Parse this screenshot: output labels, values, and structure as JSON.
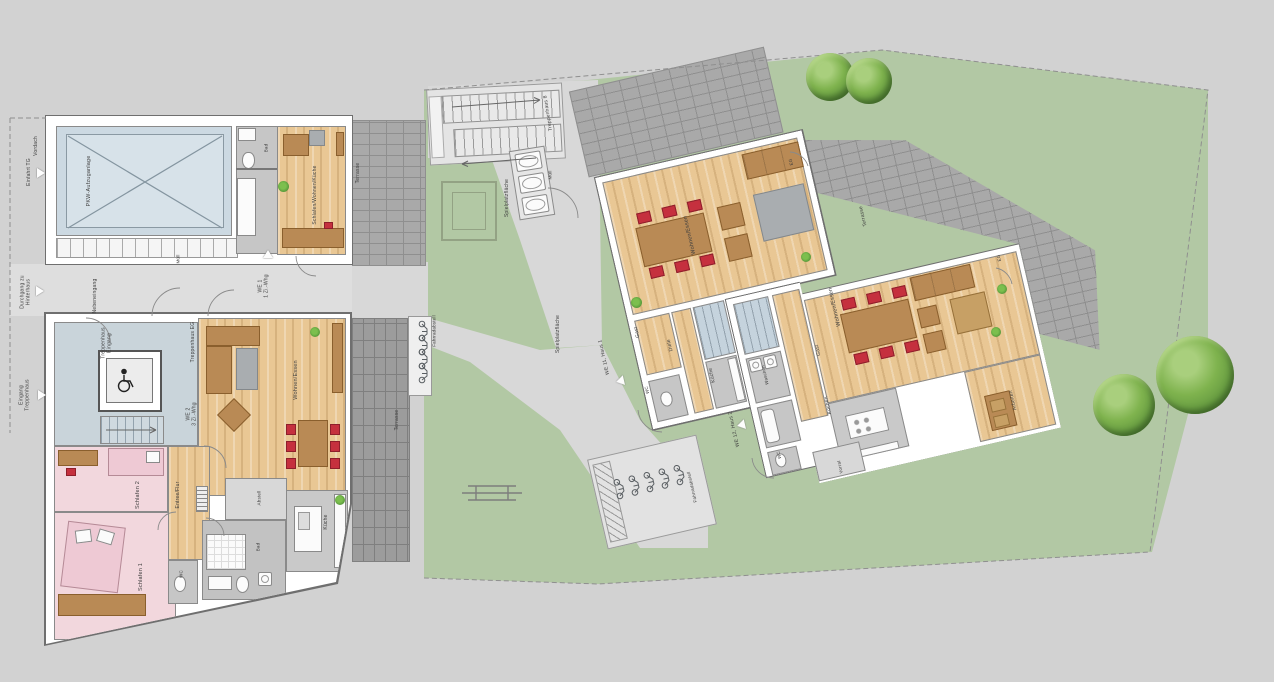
{
  "plan": {
    "title": "Lageplan Erdgeschoss Wohnanlage",
    "colors": {
      "lawn_green": "#b2c8a4",
      "path_grey": "#d8d8d8",
      "terrace_brick": "#a9a9a9",
      "terrace_brick_dark": "#9c9c9c",
      "wood_floor": "#e9c794",
      "stairwell_blue": "#c9d4da",
      "bedroom_pink": "#f2d7dd",
      "chair_red": "#c5303e",
      "furniture_brown": "#b98a55",
      "wall_white": "#ffffff",
      "label_grey": "#3f3f3f",
      "tree_green": "#6fae4b",
      "car_lift_blue": "#ccd9e2"
    },
    "icons": {
      "wheelchair-icon": "accessible elevator symbol",
      "bike-icon": "bicycle parking symbol",
      "picnic-table-icon": "bench/table symbol",
      "tree-icon": "garden tree",
      "plant-icon": "indoor plant",
      "stair-arrow-icon": "stair direction arrow",
      "direction-arrow-icon": "entrance direction triangle",
      "cross-icon": "car lift platform X marking"
    },
    "labels": [
      {
        "n": "vordach",
        "t": "Vordach",
        "x": 37,
        "y": 146,
        "r": -90,
        "s": 5
      },
      {
        "n": "einfahrt-tg",
        "t": "Einfahrt TG",
        "x": 30,
        "y": 172,
        "r": -90,
        "s": 5
      },
      {
        "n": "durchgang-zu-hinterhaus",
        "t": "Durchgang zu\nHinterhaus",
        "x": 26,
        "y": 292,
        "r": -90,
        "s": 5
      },
      {
        "n": "eingang-treppenhaus",
        "t": "Eingang\nTreppenhaus",
        "x": 25,
        "y": 395,
        "r": -90,
        "s": 5
      },
      {
        "n": "nebeneingang",
        "t": "Nebeneingang",
        "x": 96,
        "y": 296,
        "r": -90,
        "s": 5
      },
      {
        "n": "muell-garage",
        "t": "Müll",
        "x": 178,
        "y": 259,
        "r": -90,
        "s": 4.5
      },
      {
        "n": "we1",
        "t": "WE 1\n1 Zi.-Whg",
        "x": 264,
        "y": 286,
        "r": -90,
        "s": 5
      },
      {
        "n": "pkw-aufzuganlage",
        "t": "PKW-Aufzuganlage",
        "x": 89,
        "y": 181,
        "r": -90,
        "s": 5.5
      },
      {
        "n": "bad-we1",
        "t": "Bad",
        "x": 266,
        "y": 148,
        "r": -90,
        "s": 4.5
      },
      {
        "n": "schlafen-wohnen-kueche-we1",
        "t": "Schlafen/Wohnen/Küche",
        "x": 316,
        "y": 195,
        "r": -90,
        "s": 5
      },
      {
        "n": "terrasse-we1",
        "t": "Terrasse",
        "x": 359,
        "y": 173,
        "r": -90,
        "s": 5
      },
      {
        "n": "treppenhaus-eingang",
        "t": "Treppenhaus\nEingang",
        "x": 107,
        "y": 343,
        "r": -90,
        "s": 5
      },
      {
        "n": "treppenhaus-eg",
        "t": "Treppenhaus EG",
        "x": 194,
        "y": 342,
        "r": -90,
        "s": 5
      },
      {
        "n": "we2",
        "t": "WE 2\n3 Zi.-Whg",
        "x": 192,
        "y": 414,
        "r": -90,
        "s": 5
      },
      {
        "n": "wohnen-essen-we2",
        "t": "Wohnen/Essen",
        "x": 296,
        "y": 380,
        "r": -90,
        "s": 5.5
      },
      {
        "n": "schlafen-2-we2",
        "t": "Schlafen 2",
        "x": 138,
        "y": 495,
        "r": -90,
        "s": 5.5
      },
      {
        "n": "entree-flur-we2",
        "t": "Entree/Flur",
        "x": 179,
        "y": 495,
        "r": -90,
        "s": 5
      },
      {
        "n": "schlafen-1-we2",
        "t": "Schlafen 1",
        "x": 141,
        "y": 577,
        "r": -90,
        "s": 5.5
      },
      {
        "n": "wc-we2",
        "t": "WC",
        "x": 181,
        "y": 574,
        "r": -90,
        "s": 4.5
      },
      {
        "n": "bad-we2",
        "t": "Bad",
        "x": 258,
        "y": 547,
        "r": -90,
        "s": 4.5
      },
      {
        "n": "abstell-we2",
        "t": "Abstell",
        "x": 259,
        "y": 498,
        "r": -90,
        "s": 4.5
      },
      {
        "n": "kueche-we2",
        "t": "Küche",
        "x": 327,
        "y": 522,
        "r": -90,
        "s": 5
      },
      {
        "n": "terrasse-we2",
        "t": "Terrasse",
        "x": 398,
        "y": 420,
        "r": -90,
        "s": 5
      },
      {
        "n": "fahrradabstell-1",
        "t": "Fahrradabstell",
        "x": 434,
        "y": 331,
        "r": -90,
        "s": 4.5
      },
      {
        "n": "spielplatzflaeche-1",
        "t": "Spielplatzfläche",
        "x": 508,
        "y": 198,
        "r": -90,
        "s": 5
      },
      {
        "n": "treppenhaus-8",
        "t": "Treppenhaus 8",
        "x": 549,
        "y": 113,
        "r": -99,
        "s": 5
      },
      {
        "n": "muell-2",
        "t": "Müll",
        "x": 550,
        "y": 175,
        "r": -90,
        "s": 4.5
      },
      {
        "n": "spielplatzflaeche-2",
        "t": "Spielplatzfläche",
        "x": 559,
        "y": 334,
        "r": -90,
        "s": 5
      },
      {
        "n": "fahrradabstell-2",
        "t": "Fahrradabstell",
        "x": 692,
        "y": 487,
        "r": -103,
        "s": 4.5
      },
      {
        "n": "wohnen-essen-haus1",
        "t": "Wohnen/Essen",
        "x": 690,
        "y": 235,
        "r": -103,
        "s": 5.5
      },
      {
        "n": "eg-haus1",
        "t": "EG",
        "x": 791,
        "y": 162,
        "r": -103,
        "s": 4.5
      },
      {
        "n": "gast-haus1",
        "t": "Gast",
        "x": 638,
        "y": 332,
        "r": -103,
        "s": 5
      },
      {
        "n": "diele-haus1",
        "t": "Diele",
        "x": 671,
        "y": 345,
        "r": -103,
        "s": 5
      },
      {
        "n": "kueche-haus1",
        "t": "Küche",
        "x": 713,
        "y": 375,
        "r": -103,
        "s": 5
      },
      {
        "n": "wc-haus1",
        "t": "WC",
        "x": 647,
        "y": 390,
        "r": -103,
        "s": 4.5
      },
      {
        "n": "we11-haus1",
        "t": "WE 11, Haus 1",
        "x": 605,
        "y": 357,
        "r": -103,
        "s": 5
      },
      {
        "n": "waschen-haus2",
        "t": "Waschen",
        "x": 765,
        "y": 375,
        "r": -103,
        "s": 4.5
      },
      {
        "n": "we12-haus2",
        "t": "WE 12, Haus 2",
        "x": 735,
        "y": 429,
        "r": -103,
        "s": 5
      },
      {
        "n": "wohnen-essen-haus2",
        "t": "Wohnen/Essen",
        "x": 835,
        "y": 307,
        "r": -103,
        "s": 5.5
      },
      {
        "n": "gast-haus2",
        "t": "Gast",
        "x": 819,
        "y": 350,
        "r": -103,
        "s": 5
      },
      {
        "n": "kochen-haus2",
        "t": "Kochen",
        "x": 829,
        "y": 405,
        "r": -103,
        "s": 5
      },
      {
        "n": "arbeiten-haus2",
        "t": "Arbeiten",
        "x": 1014,
        "y": 400,
        "r": -103,
        "s": 5
      },
      {
        "n": "wc-haus2",
        "t": "WC",
        "x": 779,
        "y": 455,
        "r": -103,
        "s": 4.5
      },
      {
        "n": "vorrat-haus2",
        "t": "Vorrat",
        "x": 840,
        "y": 467,
        "r": -103,
        "s": 4.5
      },
      {
        "n": "eg-haus2",
        "t": "EG",
        "x": 999,
        "y": 258,
        "r": -103,
        "s": 4.5
      },
      {
        "n": "terrasse-haus2",
        "t": "Terrasse",
        "x": 864,
        "y": 216,
        "r": -103,
        "s": 5
      }
    ],
    "arrows": [
      {
        "x": 41,
        "y": 173,
        "r": 0
      },
      {
        "x": 40,
        "y": 291,
        "r": 0
      },
      {
        "x": 42,
        "y": 395,
        "r": 0
      },
      {
        "x": 268,
        "y": 254,
        "r": -90
      },
      {
        "x": 620,
        "y": 381,
        "r": 167
      },
      {
        "x": 741,
        "y": 425,
        "r": 167
      }
    ],
    "trees": [
      {
        "x": 806,
        "y": 53,
        "d": 48
      },
      {
        "x": 846,
        "y": 58,
        "d": 46
      },
      {
        "x": 1093,
        "y": 374,
        "d": 62
      },
      {
        "x": 1156,
        "y": 336,
        "d": 78
      }
    ],
    "plants": [
      {
        "x": 278,
        "y": 181,
        "d": 11
      },
      {
        "x": 310,
        "y": 327,
        "d": 10
      },
      {
        "x": 335,
        "y": 495,
        "d": 10
      },
      {
        "x": 631,
        "y": 297,
        "d": 11
      },
      {
        "x": 801,
        "y": 252,
        "d": 10
      },
      {
        "x": 997,
        "y": 284,
        "d": 10
      },
      {
        "x": 991,
        "y": 327,
        "d": 10
      }
    ]
  }
}
